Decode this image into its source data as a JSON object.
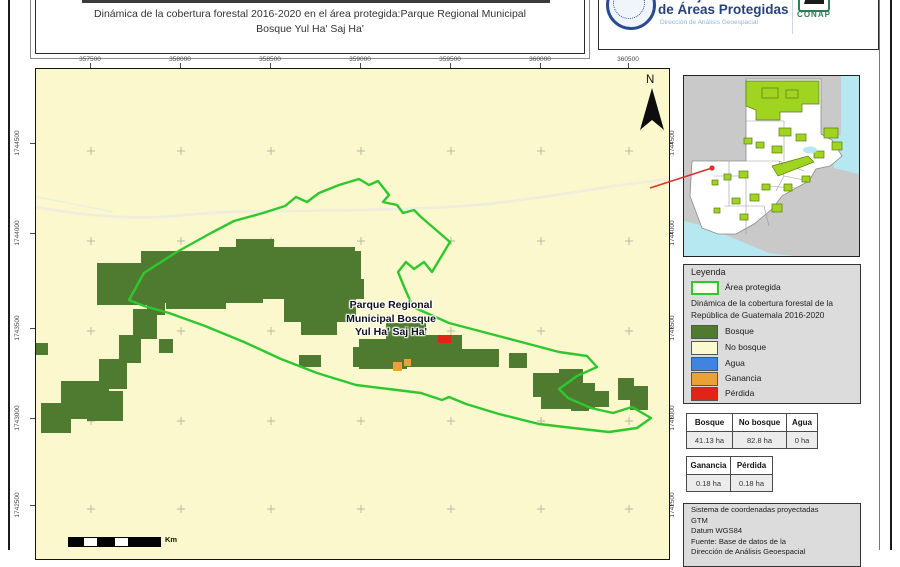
{
  "header": {
    "title_line1": "Dinámica de la cobertura forestal 2016-2020 en el área protegida:Parque Regional Municipal",
    "title_line2": "Bosque Yul Ha' Saj Ha'",
    "org": {
      "name_top": "Consejo Nacional",
      "name_bottom": "de Áreas Protegidas",
      "subtitle": "Dirección de Análisis Geoespacial",
      "conap_label": "CONAP"
    }
  },
  "map": {
    "label": [
      "Parque Regional",
      "Municipal Bosque",
      "Yul Ha' Saj Ha'"
    ],
    "north_label": "N",
    "scale_unit": "Km",
    "x_ticks": [
      "357500",
      "358000",
      "358500",
      "359000",
      "359500",
      "360000",
      "360500"
    ],
    "y_ticks": [
      "1744500",
      "1744000",
      "1743500",
      "1743000",
      "1742500"
    ]
  },
  "legend": {
    "title": "Leyenda",
    "area_protegida_label": "Área protegida",
    "subtitle_line1": "Dinámica de la cobertura forestal de la",
    "subtitle_line2": "República de Guatemala 2016-2020",
    "classes": [
      {
        "label": "Bosque",
        "color": "#4E7B2F"
      },
      {
        "label": "No bosque",
        "color": "#FAF9D0"
      },
      {
        "label": "Agua",
        "color": "#3E84E0"
      },
      {
        "label": "Ganancia",
        "color": "#E8A238"
      },
      {
        "label": "Pérdida",
        "color": "#E02418"
      }
    ]
  },
  "tables": {
    "coverage": {
      "headers": [
        "Bosque",
        "No bosque",
        "Agua"
      ],
      "values": [
        "41.13 ha",
        "82.8 ha",
        "0 ha"
      ]
    },
    "change": {
      "headers": [
        "Ganancia",
        "Pérdida"
      ],
      "values": [
        "0.18 ha",
        "0.18 ha"
      ]
    }
  },
  "info": {
    "lines": [
      "Sistema de coordenadas proyectadas",
      "GTM",
      "Datum WGS84",
      "Fuente: Base de datos de la",
      "Dirección de Análisis Geoespacial"
    ]
  },
  "colors": {
    "map_background_no_bosque": "#FAF8CC",
    "forest": "#4E7B2F",
    "protected_boundary": "#2EC82E",
    "perdida": "#E02418",
    "ganancia": "#E8A238",
    "agua": "#3E84E0",
    "panel_background": "#DCDCDC",
    "inset_protected": "#9FD420",
    "inset_water": "#B5E8F0",
    "org_navy": "#26427E",
    "conap_green": "#2E7D5B",
    "locator_line": "#E03030"
  }
}
